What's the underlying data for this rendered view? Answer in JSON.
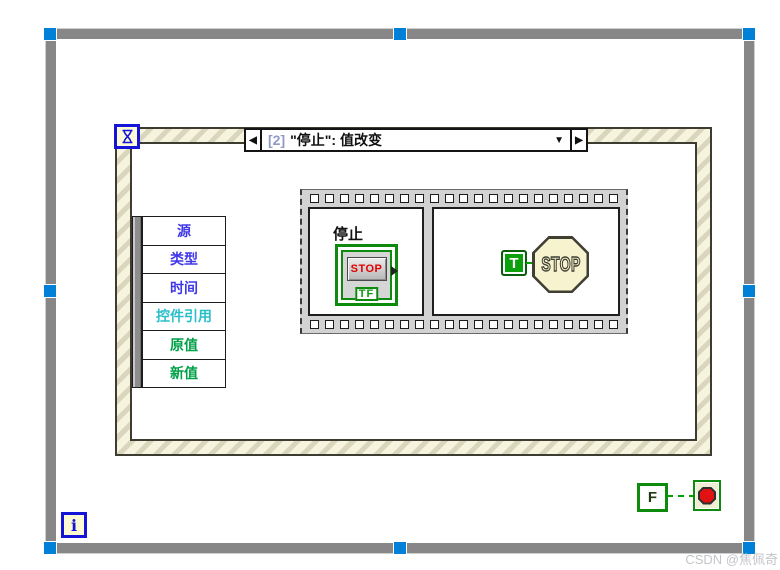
{
  "colors": {
    "labview_green": "#0E8A0E",
    "boolean_wire_green": "#00A000",
    "stop_text_red": "#E00000",
    "stop_button_red": "#E21212",
    "selection_handle_blue": "#0080D6",
    "structure_terminal_blue": "#1414D8",
    "event_border_stripe": "#D9D6BD",
    "event_border_base": "#F6F4DE",
    "loop_border_gray": "#878787"
  },
  "watermark": "CSDN @焦佩奇",
  "while_loop": {
    "iteration_label": "i"
  },
  "event_structure": {
    "case_selector": {
      "previous_arrow": "◀",
      "next_arrow": "▶",
      "dropdown_arrow": "▼",
      "case_index": "[2]",
      "case_title": "\"停止\": 值改变"
    },
    "event_data_node": {
      "items": [
        {
          "label": "源",
          "color": "#4038E8"
        },
        {
          "label": "类型",
          "color": "#4038E8"
        },
        {
          "label": "时间",
          "color": "#4038E8"
        },
        {
          "label": "控件引用",
          "color": "#2BBFC9"
        },
        {
          "label": "原值",
          "color": "#00A047"
        },
        {
          "label": "新值",
          "color": "#00A047"
        }
      ]
    }
  },
  "sequence_structure": {
    "frame1": {
      "terminal_label": "停止",
      "button_text": "STOP",
      "boolean_badge": "TF"
    },
    "frame2": {
      "true_constant_label": "T",
      "stop_sign_text": "STOP"
    }
  },
  "stop_logic": {
    "false_constant_label": "F"
  }
}
